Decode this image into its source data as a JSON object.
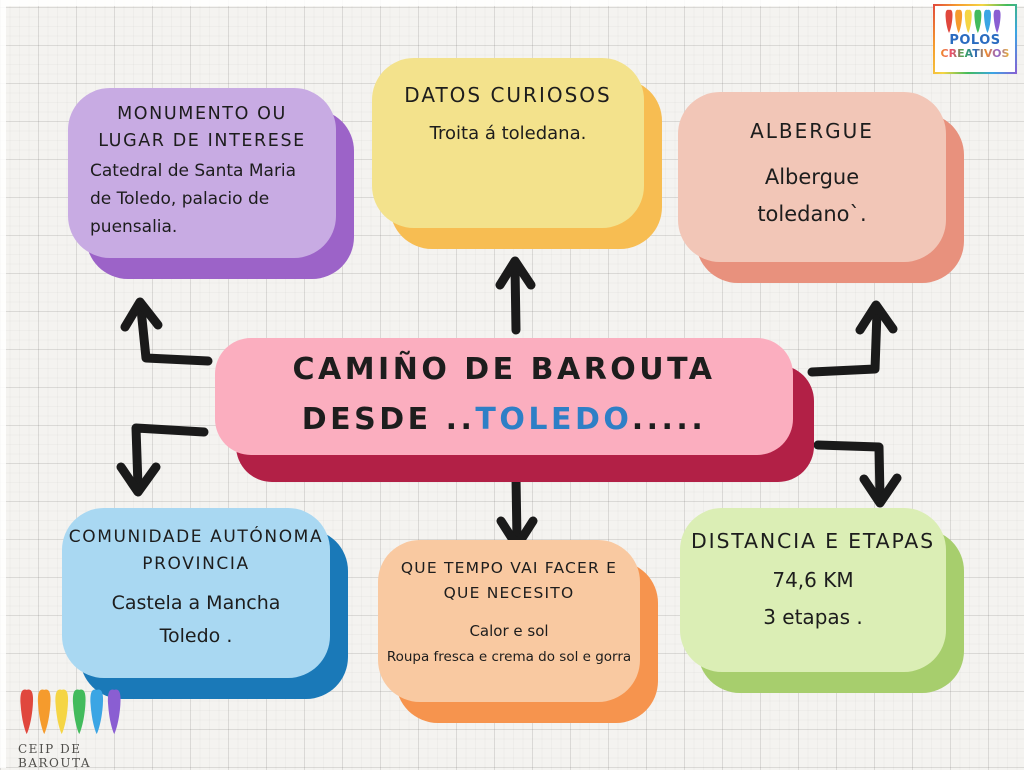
{
  "center": {
    "line1": "CAMIÑO DE BAROUTA",
    "line2_prefix": "DESDE ..",
    "line2_highlight": "TOLEDO",
    "line2_suffix": ".....",
    "highlight_color": "#2e7fc6",
    "fill": "#fbaebf",
    "shadow": "#b22046"
  },
  "nodes": {
    "monumento": {
      "title_lines": [
        "MONUMENTO OU",
        "LUGAR DE INTERESE"
      ],
      "body_lines": [
        "Catedral  de  Santa  Maria",
        "de  Toledo,  palacio de",
        "puensalia."
      ],
      "fill": "#c8abe3",
      "shadow": "#9c63c8"
    },
    "datos": {
      "title_lines": [
        "DATOS CURIOSOS"
      ],
      "body_lines": [
        "Troita á  toledana."
      ],
      "fill": "#f3e28c",
      "shadow": "#f7bd52"
    },
    "albergue": {
      "title_lines": [
        "ALBERGUE"
      ],
      "body_lines": [
        "Albergue",
        "toledano`."
      ],
      "fill": "#f2c6b7",
      "shadow": "#e8917d"
    },
    "comunidade": {
      "title_lines": [
        "COMUNIDADE AUTÓNOMA",
        "PROVINCIA"
      ],
      "body_lines": [
        "Castela  a Mancha",
        "Toledo ."
      ],
      "fill": "#a9d8f2",
      "shadow": "#1a79b8"
    },
    "tempo": {
      "title_lines": [
        "QUE TEMPO VAI FACER E",
        "QUE NECESITO"
      ],
      "body_lines": [
        "Calor e sol",
        "Roupa fresca e crema do sol e gorra"
      ],
      "fill": "#f9c9a1",
      "shadow": "#f6944e"
    },
    "distancia": {
      "title_lines": [
        "DISTANCIA E ETAPAS"
      ],
      "body_lines": [
        "74,6 KM",
        "3 etapas ."
      ],
      "fill": "#dbeeb5",
      "shadow": "#a7ce6d"
    }
  },
  "arrows": {
    "color": "#1a1a1a"
  },
  "logos": {
    "polos": {
      "line1": "POLOS",
      "line2": "CREATIVOS",
      "line1_color": "#2a6cc0"
    },
    "ceip": {
      "label": "CEIP DE BAROUTA",
      "color": "#504f4b"
    },
    "stroke_colors": [
      "#e0473d",
      "#f59b2d",
      "#f5d544",
      "#42bb5c",
      "#3ba5e4",
      "#8a5ed2"
    ]
  }
}
